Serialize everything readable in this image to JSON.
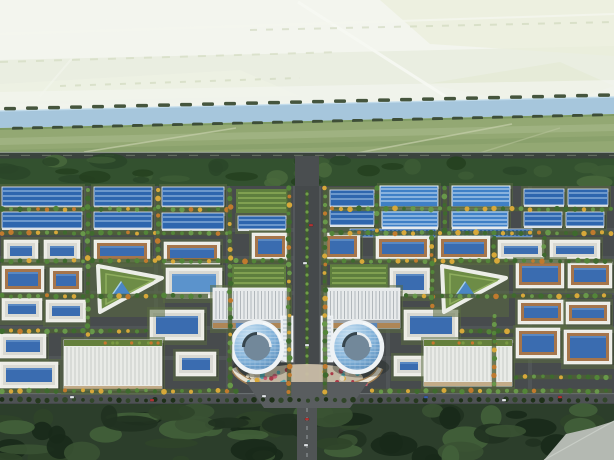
{
  "scene": {
    "width": 614,
    "height": 460,
    "seed": 7,
    "palette": {
      "skyTop": "#f5f7f1",
      "skyBottom": "#e9ede0",
      "canal": "#a6c6dc",
      "canalEdge": "#c2dcec",
      "bank": "#7e9a62",
      "fieldNear": "#93a873",
      "fieldStrip": "#a3b484",
      "highway": "#3a433d",
      "highwayEdge": "#99a396",
      "hedge": "#33512f",
      "street": "#474b4d",
      "streetLight": "#565a5c",
      "roadPerimeter": "#4e5254",
      "roadSouth": "#505455",
      "intersection": "#595d5f",
      "forest": "#2c3e2b",
      "wedge": "#b4b9b2",
      "roofBlue": "#2e66ae",
      "roofBlueStripe": "#a9c9ea",
      "roofWarehouse": "#3f80c6",
      "roofWarehouseStripe": "#cfe3f6",
      "wallWhite": "#ececE6",
      "rimTan": "#a5754b",
      "rimGray": "#d9d9d2",
      "glassCenter": "#3a6cb0",
      "glassPool": "#5b93cc",
      "garden": "#5e7e3e",
      "gardenRow": "#86a554",
      "fanBase": "#e7eaeb",
      "fanRib": "#b2b8bc",
      "fanTan": "#ae8656",
      "hallBase": "#e9ebe7",
      "hallStripe": "#c6cbc7",
      "hallGarden": "#647f3c",
      "towerRing": "#eef2f5",
      "towerCourt": "#72889a",
      "median": "#3f5a30",
      "medianDot": "#6fa045",
      "lawn": "#4e5f37",
      "plazaBase": "#c9bda6",
      "arcade": "#e8e2d4",
      "arcadeShadow": "#b08a58"
    },
    "treeColors": [
      "#3e6a2e",
      "#538539",
      "#68984a"
    ],
    "treeYellow": "#d7a83a",
    "treeOrange": "#c07a2e",
    "darkTree": [
      "#26391f",
      "#1e3019",
      "#31462a"
    ],
    "flowerColors": [
      "#c75e72",
      "#a93a48",
      "#4fa4ac",
      "#e0d7c2",
      "#d8a83a"
    ],
    "carColors": {
      "w": "#dfe3e6",
      "r": "#b23434",
      "b": "#3a5fae"
    },
    "bgPolys": [
      [
        [
          [
            0,
            0
          ],
          [
            614,
            0
          ],
          [
            614,
            46
          ],
          [
            0,
            60
          ]
        ],
        "#f3f5ee",
        1
      ],
      [
        [
          [
            0,
            60
          ],
          [
            614,
            46
          ],
          [
            614,
            100
          ],
          [
            0,
            104
          ]
        ],
        "#eaeee1",
        1
      ],
      [
        [
          [
            380,
            0
          ],
          [
            614,
            0
          ],
          [
            614,
            56
          ],
          [
            430,
            44
          ]
        ],
        "#e9eeda",
        0.7
      ],
      [
        [
          [
            426,
            84
          ],
          [
            560,
            62
          ],
          [
            614,
            86
          ],
          [
            548,
            108
          ]
        ],
        "#e2e9d2",
        0.6
      ],
      [
        [
          [
            0,
            84
          ],
          [
            240,
            70
          ],
          [
            300,
            96
          ],
          [
            0,
            102
          ]
        ],
        "#eef1e4",
        0.8
      ],
      [
        [
          [
            0,
            92
          ],
          [
            614,
            80
          ],
          [
            614,
            104
          ],
          [
            0,
            112
          ]
        ],
        "#f2f4ee",
        0.75
      ]
    ],
    "bgLines": [
      [
        [
          298,
          2,
          448,
          98
        ],
        "#f7f9f3",
        3,
        0.9,
        ""
      ],
      [
        [
          0,
          34,
          614,
          14
        ],
        "#f5f7ef",
        2,
        0.8,
        ""
      ],
      [
        [
          120,
          2,
          40,
          96
        ],
        "#f3f6ee",
        2,
        0.6,
        ""
      ],
      [
        [
          250,
          30,
          614,
          22
        ],
        "#c7d1b2",
        2,
        0.5,
        "7 9"
      ],
      [
        [
          0,
          62,
          340,
          52
        ],
        "#ccd5b6",
        2,
        0.5,
        "8 10"
      ],
      [
        [
          60,
          86,
          300,
          78
        ],
        "#c4cfae",
        2,
        0.45,
        "6 9"
      ]
    ],
    "canalPoly": [
      [
        0,
        111
      ],
      [
        614,
        97
      ],
      [
        614,
        114
      ],
      [
        0,
        128
      ]
    ],
    "bankPoly": [
      [
        0,
        128
      ],
      [
        614,
        114
      ],
      [
        614,
        121
      ],
      [
        0,
        135
      ]
    ],
    "fieldPoly": [
      [
        0,
        130
      ],
      [
        614,
        116
      ],
      [
        614,
        158
      ],
      [
        0,
        158
      ]
    ],
    "fieldStrips": [
      [
        [
          [
            0,
            138
          ],
          [
            614,
            124
          ],
          [
            614,
            131
          ],
          [
            0,
            145
          ]
        ],
        "#a3b484",
        0.8
      ],
      [
        [
          [
            0,
            150
          ],
          [
            614,
            136
          ],
          [
            614,
            141
          ],
          [
            0,
            155
          ]
        ],
        "#8aa06b",
        0.9
      ]
    ],
    "fieldPaths": [
      [
        [
          84,
          152,
          236,
          128
        ],
        "#c6cfab",
        1.6,
        0.7,
        ""
      ],
      [
        [
          352,
          154,
          512,
          124
        ],
        "#c6cfab",
        1.6,
        0.7,
        ""
      ],
      [
        [
          470,
          156,
          560,
          128
        ],
        "#bcc79f",
        1.4,
        0.5,
        ""
      ]
    ],
    "streetsV": [
      86,
      156,
      228,
      388,
      458,
      530
    ],
    "streetsH": [
      230,
      258,
      293,
      328,
      358
    ],
    "buildings": [
      [
        "f",
        2,
        187,
        80,
        19
      ],
      [
        "f",
        94,
        187,
        58,
        19
      ],
      [
        "f",
        162,
        187,
        62,
        19
      ],
      [
        "f",
        2,
        212,
        80,
        16
      ],
      [
        "f",
        94,
        212,
        58,
        16
      ],
      [
        "f",
        162,
        213,
        62,
        16
      ],
      [
        "f",
        238,
        216,
        48,
        13
      ],
      [
        "f",
        330,
        190,
        44,
        16
      ],
      [
        "f",
        330,
        210,
        44,
        15
      ],
      [
        "f",
        524,
        189,
        40,
        16
      ],
      [
        "f",
        568,
        189,
        40,
        16
      ],
      [
        "f",
        524,
        212,
        38,
        14
      ],
      [
        "f",
        566,
        212,
        38,
        14
      ],
      [
        "w",
        380,
        186,
        58,
        21
      ],
      [
        "w",
        452,
        186,
        58,
        21
      ],
      [
        "w",
        382,
        209,
        56,
        18
      ],
      [
        "w",
        452,
        209,
        56,
        18
      ],
      [
        "s",
        350,
        229,
        86,
        8
      ],
      [
        "s",
        452,
        229,
        80,
        8
      ],
      [
        "g",
        236,
        189,
        52,
        24
      ],
      [
        "g",
        232,
        264,
        54,
        32
      ],
      [
        "g",
        330,
        264,
        58,
        32
      ],
      [
        "c",
        4,
        240,
        34,
        22,
        0
      ],
      [
        "c",
        44,
        240,
        36,
        22,
        0
      ],
      [
        "c",
        94,
        240,
        56,
        22,
        1
      ],
      [
        "c",
        164,
        242,
        56,
        22,
        1
      ],
      [
        "c",
        252,
        233,
        36,
        27,
        1
      ],
      [
        "c",
        324,
        233,
        36,
        27,
        1
      ],
      [
        "c",
        376,
        236,
        54,
        24,
        1
      ],
      [
        "c",
        438,
        236,
        52,
        24,
        1
      ],
      [
        "c",
        498,
        240,
        46,
        20,
        0
      ],
      [
        "c",
        550,
        240,
        50,
        20,
        0
      ],
      [
        "c",
        2,
        266,
        42,
        26,
        1
      ],
      [
        "c",
        50,
        268,
        32,
        24,
        1
      ],
      [
        "c",
        2,
        298,
        40,
        22,
        0
      ],
      [
        "c",
        46,
        300,
        40,
        22,
        0
      ],
      [
        "c",
        166,
        268,
        56,
        30,
        2
      ],
      [
        "c",
        390,
        268,
        40,
        28,
        0
      ],
      [
        "c",
        516,
        260,
        48,
        28,
        1
      ],
      [
        "c",
        568,
        262,
        44,
        26,
        1
      ],
      [
        "c",
        150,
        310,
        54,
        30,
        0
      ],
      [
        "c",
        404,
        310,
        54,
        30,
        0
      ],
      [
        "c",
        518,
        300,
        46,
        24,
        1
      ],
      [
        "c",
        566,
        302,
        44,
        22,
        1
      ],
      [
        "c",
        0,
        334,
        46,
        24,
        0
      ],
      [
        "c",
        0,
        362,
        58,
        26,
        0
      ],
      [
        "c",
        516,
        328,
        44,
        30,
        1
      ],
      [
        "c",
        564,
        330,
        48,
        34,
        1
      ],
      [
        "c",
        176,
        352,
        40,
        24,
        0
      ],
      [
        "c",
        394,
        356,
        30,
        20,
        0
      ],
      [
        "tri",
        92,
        262,
        70,
        50
      ],
      [
        "tri",
        436,
        262,
        70,
        50
      ],
      [
        "fan",
        213,
        288,
        76,
        40
      ],
      [
        "fan",
        324,
        288,
        76,
        40
      ],
      [
        "hall",
        64,
        340,
        98,
        50
      ],
      [
        "hall",
        424,
        340,
        88,
        46
      ],
      [
        "slab",
        281,
        316,
        12,
        46
      ],
      [
        "slab",
        321,
        316,
        12,
        46
      ]
    ],
    "towers": [
      [
        257,
        347,
        27
      ],
      [
        357,
        347,
        27
      ]
    ],
    "boulevard": {
      "stub": [
        295,
        156,
        24,
        34
      ],
      "main": [
        294,
        186,
        26,
        210
      ],
      "median": [
        305.5,
        190,
        3,
        196
      ]
    },
    "southRoad": [
      297,
      404,
      20,
      56
    ],
    "intersectionPoly": [
      [
        246,
        382
      ],
      [
        368,
        382
      ],
      [
        350,
        408
      ],
      [
        264,
        408
      ]
    ],
    "perimeterRoad": [
      0,
      393,
      614,
      11
    ],
    "plaza": {
      "base": [
        307,
        378,
        56,
        14
      ],
      "clusters": [
        [
          270,
          378
        ],
        [
          344,
          378
        ]
      ],
      "arcLeft": "M 234 368 Q 240 386 292 390",
      "arcRight": "M 380 368 Q 374 386 322 390"
    },
    "treeRows": [
      [
        209,
        2,
        228
      ],
      [
        209,
        332,
        612
      ],
      [
        233,
        2,
        228
      ],
      [
        233,
        332,
        612
      ],
      [
        261,
        2,
        286
      ],
      [
        261,
        326,
        612
      ],
      [
        296,
        2,
        208
      ],
      [
        296,
        406,
        612
      ],
      [
        331,
        2,
        146
      ],
      [
        331,
        462,
        514
      ],
      [
        377,
        516,
        612
      ],
      [
        391,
        2,
        238
      ],
      [
        391,
        372,
        612
      ],
      [
        400,
        2,
        612,
        "d"
      ]
    ],
    "treeCols": [
      [
        88,
        190,
        336
      ],
      [
        158,
        190,
        258
      ],
      [
        230,
        190,
        390
      ],
      [
        289,
        188,
        396
      ],
      [
        325,
        188,
        396
      ],
      [
        377,
        188,
        234
      ],
      [
        445,
        188,
        234
      ],
      [
        432,
        238,
        306
      ],
      [
        494,
        238,
        258
      ],
      [
        494,
        316,
        390
      ],
      [
        544,
        238,
        256
      ]
    ],
    "canalDashTop": {
      "step": 22,
      "len": 12,
      "h": 3.5,
      "color": "#45553d"
    },
    "canalDashBottom": {
      "step": 20,
      "len": 11,
      "h": 3.5,
      "color": "#3e4e37"
    },
    "hedgeBand": [
      0,
      158.5,
      614,
      27.5
    ],
    "forestBand": [
      0,
      404,
      614,
      56
    ],
    "wedgePoly": [
      [
        544,
        460
      ],
      [
        566,
        434
      ],
      [
        592,
        428
      ],
      [
        614,
        421
      ],
      [
        614,
        460
      ]
    ],
    "cars": [
      [
        70,
        396,
        "w"
      ],
      [
        150,
        399,
        "r"
      ],
      [
        262,
        395,
        "w"
      ],
      [
        424,
        396,
        "b"
      ],
      [
        502,
        399,
        "w"
      ],
      [
        558,
        396,
        "r"
      ],
      [
        305,
        418,
        "r"
      ],
      [
        304,
        444,
        "w"
      ],
      [
        303,
        262,
        "w"
      ],
      [
        309,
        224,
        "r"
      ],
      [
        305,
        344,
        "w"
      ]
    ]
  }
}
